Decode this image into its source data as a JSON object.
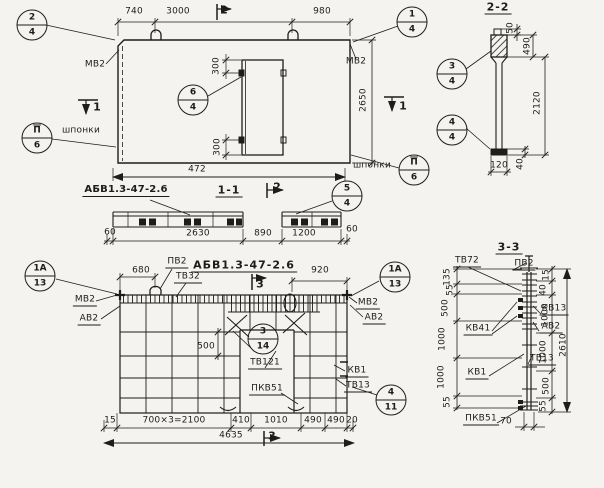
{
  "plan": {
    "dims": {
      "w1": "740",
      "w2": "3000",
      "w3": "980",
      "height": "2650",
      "total": "472",
      "open_top": "300",
      "open_bot": "300"
    },
    "labels": {
      "mv2_left": "МВ2",
      "mv2_right": "МВ2",
      "keys_left": "шпонки",
      "keys_right": "шпонки"
    },
    "marks": {
      "cut1_left": "1",
      "cut1_right": "1",
      "cut2_top": "2"
    },
    "callouts": {
      "c24": {
        "num": "2",
        "sheet": "4"
      },
      "c14": {
        "num": "1",
        "sheet": "4"
      },
      "c64": {
        "num": "6",
        "sheet": "4"
      },
      "key_left": {
        "num": "П",
        "sheet": "6"
      },
      "key_right": {
        "num": "П",
        "sheet": "6"
      }
    }
  },
  "sec11": {
    "title": "1-1",
    "part_mark": "АБВ1.3-47-2.6",
    "cut2": "2",
    "callout_c54": {
      "num": "5",
      "sheet": "4"
    },
    "dims": {
      "left60": "60",
      "d2630": "2630",
      "d890": "890",
      "d1200": "1200",
      "right60": "60"
    }
  },
  "sec22": {
    "title": "2-2",
    "callouts": {
      "c34": {
        "num": "3",
        "sheet": "4"
      },
      "c44": {
        "num": "4",
        "sheet": "4"
      }
    },
    "dims": {
      "d50": "50",
      "d490": "490",
      "d2120": "2120",
      "d40": "40",
      "d120": "120"
    }
  },
  "reinf": {
    "title": "АБВ1.3-47-2.6",
    "cut3_top": "3",
    "cut3_bot": "3",
    "callouts": {
      "left_1a13": {
        "num": "1А",
        "sheet": "13"
      },
      "right_1a13": {
        "num": "1А",
        "sheet": "13"
      },
      "c314": {
        "num": "3",
        "sheet": "14"
      },
      "c411": {
        "num": "4",
        "sheet": "11"
      }
    },
    "labels": {
      "pv2": "ПВ2",
      "tv32": "ТВ32",
      "mv2_left": "МВ2",
      "av2_left": "АВ2",
      "mv2_right": "МВ2",
      "av2_right": "АВ2",
      "tv121": "ТВ121",
      "pkv51": "ПКВ51",
      "kv1": "КВ1",
      "tv13": "ТВ13"
    },
    "dims": {
      "d680": "680",
      "d920": "920",
      "d500": "500",
      "d15": "15",
      "d700x3": "700×3=2100",
      "d410": "410",
      "d1010": "1010",
      "d490a": "490",
      "d490b": "490",
      "d20": "20",
      "total": "4635"
    }
  },
  "sec33": {
    "title": "3-3",
    "labels": {
      "tv72": "ТВ72",
      "pv2": "ПВ2",
      "kv13": "КВ13",
      "av2": "АВ2",
      "tv13": "ТВ13",
      "kv41": "КВ41",
      "kv1": "КВ1",
      "pkv51": "ПКВ51"
    },
    "dims_left": {
      "d135": "135",
      "d55_top": "55",
      "d500": "500",
      "d1000_a": "1000",
      "d1000_b": "1000",
      "d55_bot": "55"
    },
    "dims_right": {
      "d15": "15",
      "d40": "40",
      "d1000_a": "1000",
      "d1000_b": "1000",
      "d500": "500",
      "d55": "55",
      "total": "2610"
    },
    "dim_width": "70"
  }
}
